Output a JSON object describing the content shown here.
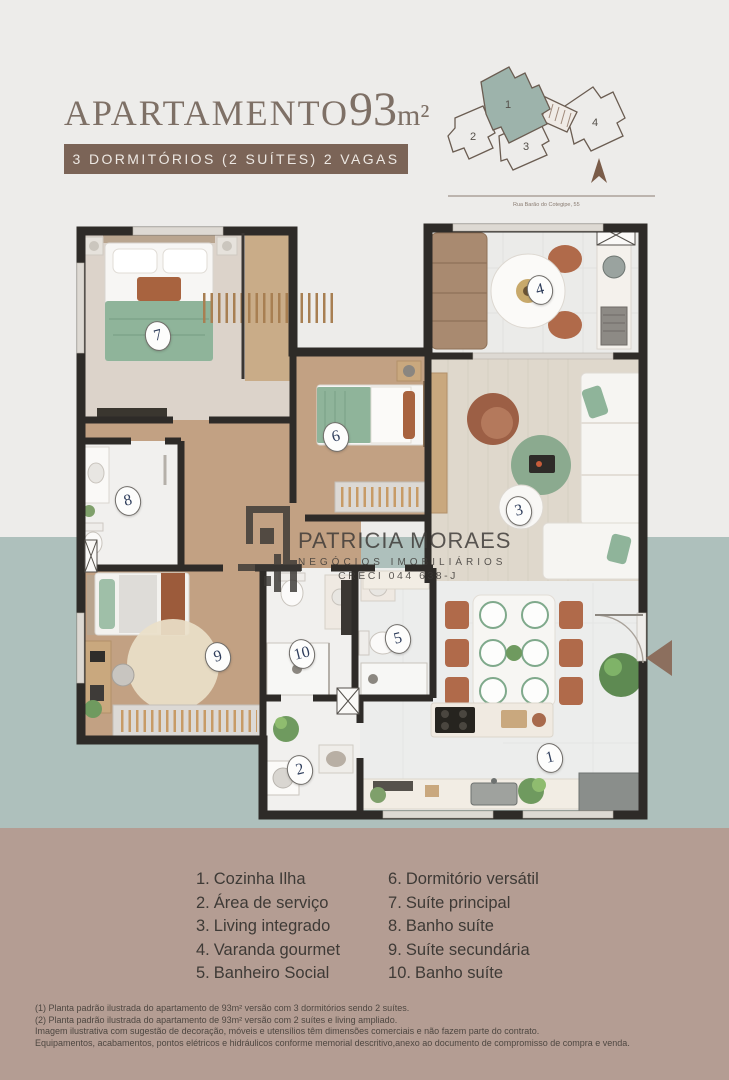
{
  "header": {
    "title_text": "APARTAMENTO",
    "area": "93",
    "unit": "m²",
    "badge": "3 DORMITÓRIOS (2 SUÍTES) 2 VAGAS"
  },
  "siteplan": {
    "units": [
      {
        "number": "1",
        "highlighted": true
      },
      {
        "number": "2",
        "highlighted": false
      },
      {
        "number": "3",
        "highlighted": false
      },
      {
        "number": "4",
        "highlighted": false
      }
    ],
    "street_label": "Rua Barão do Cotegipe, 55"
  },
  "plan": {
    "markers": [
      {
        "number": "1"
      },
      {
        "number": "2"
      },
      {
        "number": "3"
      },
      {
        "number": "4"
      },
      {
        "number": "5"
      },
      {
        "number": "6"
      },
      {
        "number": "7"
      },
      {
        "number": "8"
      },
      {
        "number": "9"
      },
      {
        "number": "10"
      }
    ]
  },
  "watermark": {
    "name": "PATRICIA MORAES",
    "subtitle": "NEGÓCIOS IMOBILIÁRIOS",
    "creci": "CRECI 044 638-J"
  },
  "legend": {
    "col1": [
      {
        "num": "1.",
        "label": "Cozinha Ilha"
      },
      {
        "num": "2.",
        "label": "Área de serviço"
      },
      {
        "num": "3.",
        "label": "Living integrado"
      },
      {
        "num": "4.",
        "label": "Varanda gourmet"
      },
      {
        "num": "5.",
        "label": "Banheiro Social"
      }
    ],
    "col2": [
      {
        "num": "6.",
        "label": "Dormitório versátil"
      },
      {
        "num": "7.",
        "label": "Suíte principal"
      },
      {
        "num": "8.",
        "label": "Banho suíte"
      },
      {
        "num": "9.",
        "label": "Suíte secundária"
      },
      {
        "num": "10.",
        "label": "Banho suíte"
      }
    ]
  },
  "footer": {
    "lines": [
      "(1) Planta padrão ilustrada do apartamento de 93m² versão com 3 dormitórios sendo 2 suítes.",
      "(2) Planta padrão ilustrada do apartamento de 93m² versão com 2 suítes e living ampliado.",
      "Imagem ilustrativa com sugestão de decoração, móveis e utensílios têm dimensões comerciais e não fazem parte do contrato.",
      "Equipamentos, acabamentos, pontos elétricos e hidráulicos conforme memorial descritivo,anexo ao documento de compromisso de compra e venda."
    ]
  },
  "colors": {
    "accent_brown": "#7B6457",
    "title": "#7E7066",
    "band_teal": "#AEC0BC",
    "band_mauve": "#B49D93",
    "wall": "#2E2B28",
    "marker_number": "#2F3E5C",
    "unit_highlight": "#9DB3AB",
    "entrance_arrow": "#8C6F5E",
    "wood_floor": "#C2A183",
    "green_textile": "#8FB49A",
    "terracotta": "#B06A4A"
  }
}
